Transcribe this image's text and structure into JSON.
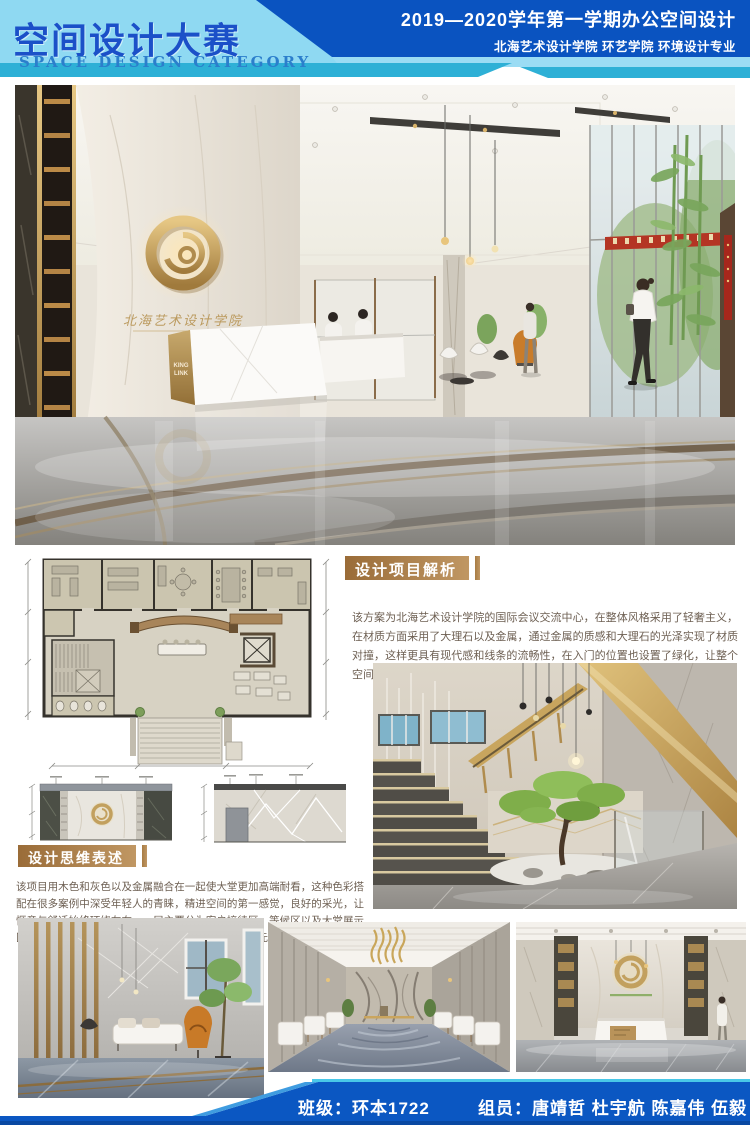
{
  "header": {
    "title": "空间设计大赛",
    "subtitle": "SPACE DESIGN CATEGORY",
    "right_line1": "2019—2020学年第一学期办公空间设计",
    "right_line2": "北海艺术设计学院  环艺学院  环境设计专业"
  },
  "sections": {
    "analysis": {
      "title": "设计项目解析",
      "body": "该方案为北海艺术设计学院的国际会议交流中心，在整体风格采用了轻奢主义，在材质方面采用了大理石以及金属，通过金属的质感和大理石的光泽实现了材质对撞，这样更具有现代感和线条的流畅性，在入门的位置也设置了绿化，让整个空间更加丰富又不显单一，在洽谈区墙面的元素上采用了多边形切割的方式。"
    },
    "thinking": {
      "title": "设计思维表述",
      "body": "该项目用木色和灰色以及金属融合在一起使大堂更加高端耐看，这种色彩搭配在很多案例中深受年轻人的青睐，精进空间的第一感觉，良好的采光，让惬意与舒适始终环绕左右，一层主要分为客户接待区，等候区以及大堂展示区，在楼梯入口处也添加了植物配景，凸显大自然的元素。"
    }
  },
  "main_render": {
    "logo_caption": "北海艺术设计学院",
    "desk_sign_1": "KING",
    "desk_sign_2": "LINK"
  },
  "footer": {
    "class_label": "班级：环本1722",
    "members": "组员：唐靖哲  杜宇航  陈嘉伟  伍毅"
  },
  "colors": {
    "light_blue": "#8fd9f2",
    "dark_blue": "#0a53c0",
    "teal": "#2eb0d6",
    "tag_tan": "#ad7c48",
    "gold": "#c2a05e",
    "footer_blue": "#0b57c2"
  }
}
